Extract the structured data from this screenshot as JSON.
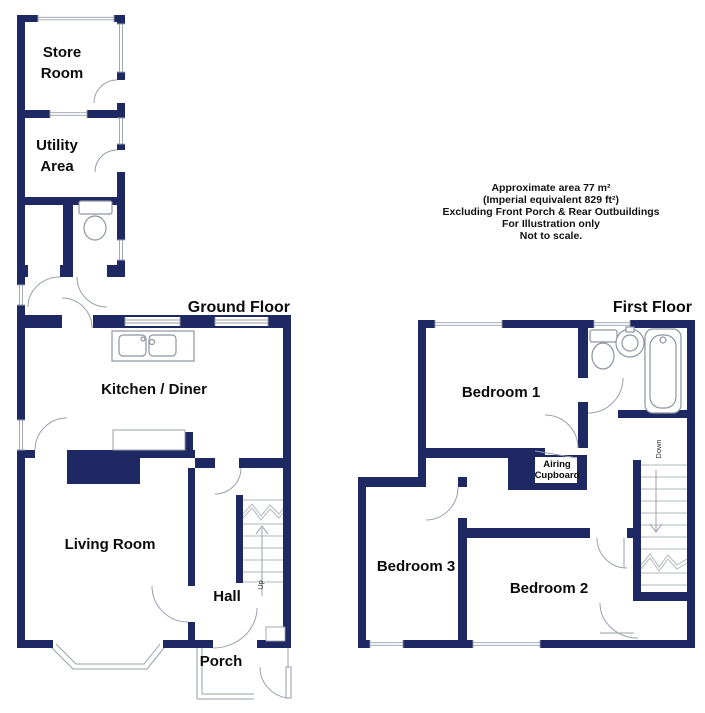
{
  "colors": {
    "wall": "#1e2963",
    "line": "#99a0ab",
    "text": "#0b0b0c",
    "background": "#ffffff"
  },
  "floors": {
    "ground": {
      "title": "Ground Floor",
      "rooms": {
        "store_room": {
          "line1": "Store",
          "line2": "Room"
        },
        "utility": {
          "line1": "Utility",
          "line2": "Area"
        },
        "kitchen": "Kitchen / Diner",
        "living": "Living Room",
        "hall": "Hall",
        "porch": "Porch"
      },
      "stairs_label": "Up",
      "fixtures": [
        "toilet-icon",
        "kitchen-sink-icon",
        "bay-window-icon"
      ]
    },
    "first": {
      "title": "First Floor",
      "rooms": {
        "bedroom1": "Bedroom 1",
        "bedroom2": "Bedroom 2",
        "bedroom3": "Bedroom 3",
        "airing": {
          "line1": "Airing",
          "line2": "Cupboard"
        }
      },
      "stairs_label": "Down",
      "fixtures": [
        "toilet-icon",
        "basin-icon",
        "bath-icon"
      ]
    }
  },
  "annotation": {
    "line1": "Approximate area 77 m²",
    "line2": "(Imperial equivalent 829 ft²)",
    "line3": "Excluding Front Porch & Rear Outbuildings",
    "line4": "For Illustration only",
    "line5": "Not to scale."
  }
}
